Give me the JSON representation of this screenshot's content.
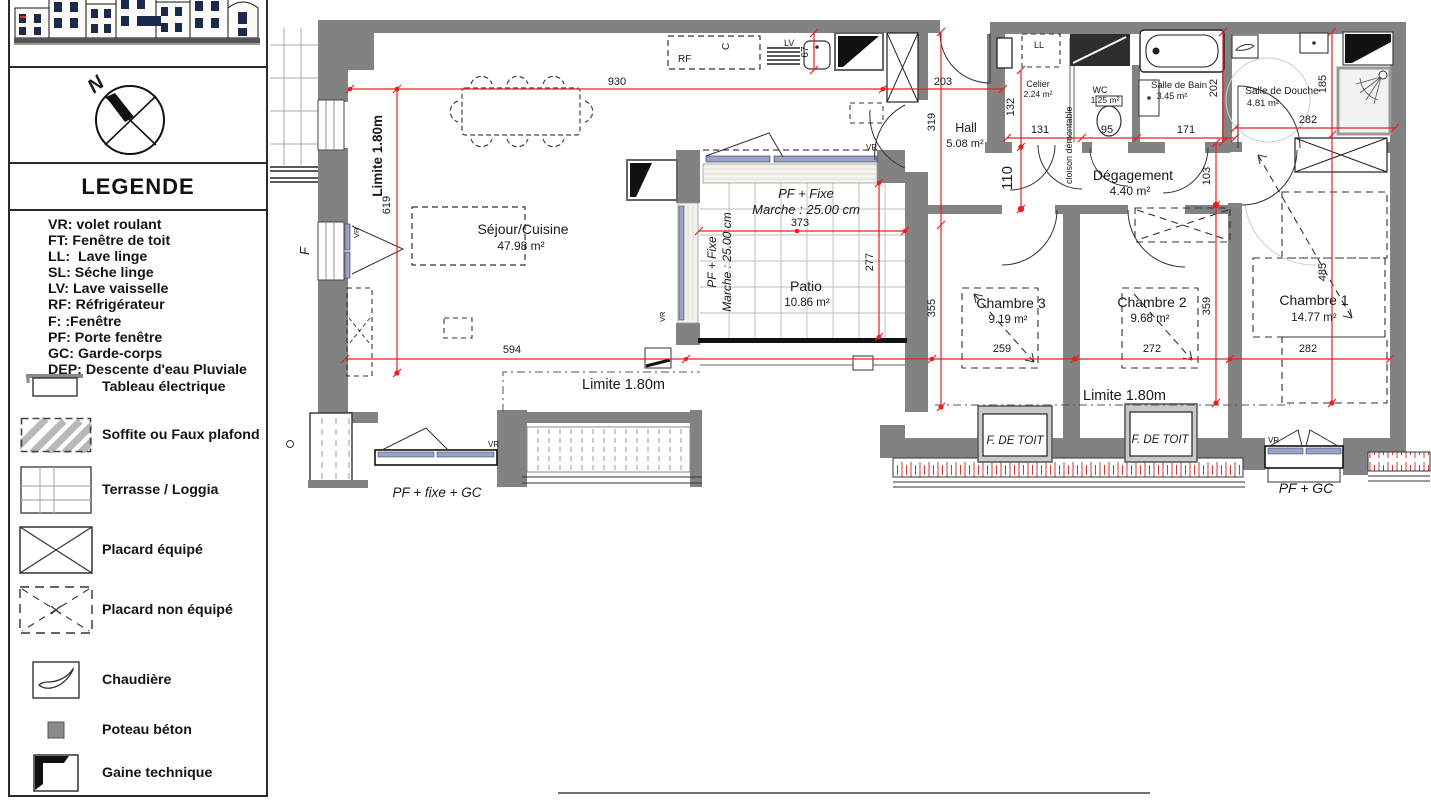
{
  "legend": {
    "title": "LEGENDE",
    "compass_north": "N",
    "abbreviations": [
      "VR: volet roulant",
      "FT: Fenêtre de toit",
      "LL:  Lave linge",
      "SL: Séche linge",
      "LV: Lave vaisselle",
      "RF: Réfrigérateur",
      "F: :Fenêtre",
      "PF: Porte fenêtre",
      "GC: Garde-corps",
      "DEP: Descente d'eau Pluviale"
    ],
    "symbols": [
      {
        "icon": "electrical-panel-icon",
        "label": "Tableau électrique"
      },
      {
        "icon": "soffit-icon",
        "label": "Soffite ou Faux plafond"
      },
      {
        "icon": "terrace-icon",
        "label": "Terrasse / Loggia"
      },
      {
        "icon": "equipped-closet-icon",
        "label": "Placard équipé"
      },
      {
        "icon": "unequipped-closet-icon",
        "label": "Placard  non équipé"
      },
      {
        "icon": "boiler-icon",
        "label": "Chaudière"
      },
      {
        "icon": "concrete-post-icon",
        "label": "Poteau béton"
      },
      {
        "icon": "technical-duct-icon",
        "label": "Gaine technique"
      }
    ]
  },
  "plan": {
    "rooms": [
      {
        "name": "Séjour/Cuisine",
        "area": "47.98 m²"
      },
      {
        "name": "Patio",
        "area": "10.86 m²"
      },
      {
        "name": "Hall",
        "area": "5.08 m²"
      },
      {
        "name": "Celier",
        "area": "2.24 m²"
      },
      {
        "name": "WC",
        "area": "1.25 m²"
      },
      {
        "name": "Salle de Bain",
        "area": "3.45 m²"
      },
      {
        "name": "Salle de Douche",
        "area": "4.81 m²"
      },
      {
        "name": "Dégagement",
        "area": "4.40 m²"
      },
      {
        "name": "Chambre 3",
        "area": "9.19 m²"
      },
      {
        "name": "Chambre 2",
        "area": "9.68 m²"
      },
      {
        "name": "Chambre 1",
        "area": "14.77 m²"
      }
    ],
    "annotations": {
      "limite": "Limite 1.80m",
      "pf_fixe": "PF + Fixe",
      "marche": "Marche : 25.00 cm",
      "pf_fixe_gc": "PF + fixe + GC",
      "pf_gc": "PF + GC",
      "f_de_toit": "F. DE TOIT",
      "cloison": "cloison démontable",
      "vr": "VR",
      "f": "F",
      "ll": "LL",
      "rf": "RF",
      "c": "C",
      "lv": "LV"
    },
    "dimensions": {
      "d930": "930",
      "d619": "619",
      "d67": "67",
      "d203": "203",
      "d319": "319",
      "d132": "132",
      "d110": "110",
      "d131": "131",
      "d95": "95",
      "d171": "171",
      "d202": "202",
      "d282top": "282",
      "d185": "185",
      "d103": "103",
      "d373": "373",
      "d277": "277",
      "d355": "355",
      "d594": "594",
      "d259": "259",
      "d272": "272",
      "d282bot": "282",
      "d359": "359",
      "d485": "485"
    },
    "colors": {
      "wall": "#828282",
      "dimension": "#e8201e",
      "glazing": "#98a2cd"
    }
  }
}
